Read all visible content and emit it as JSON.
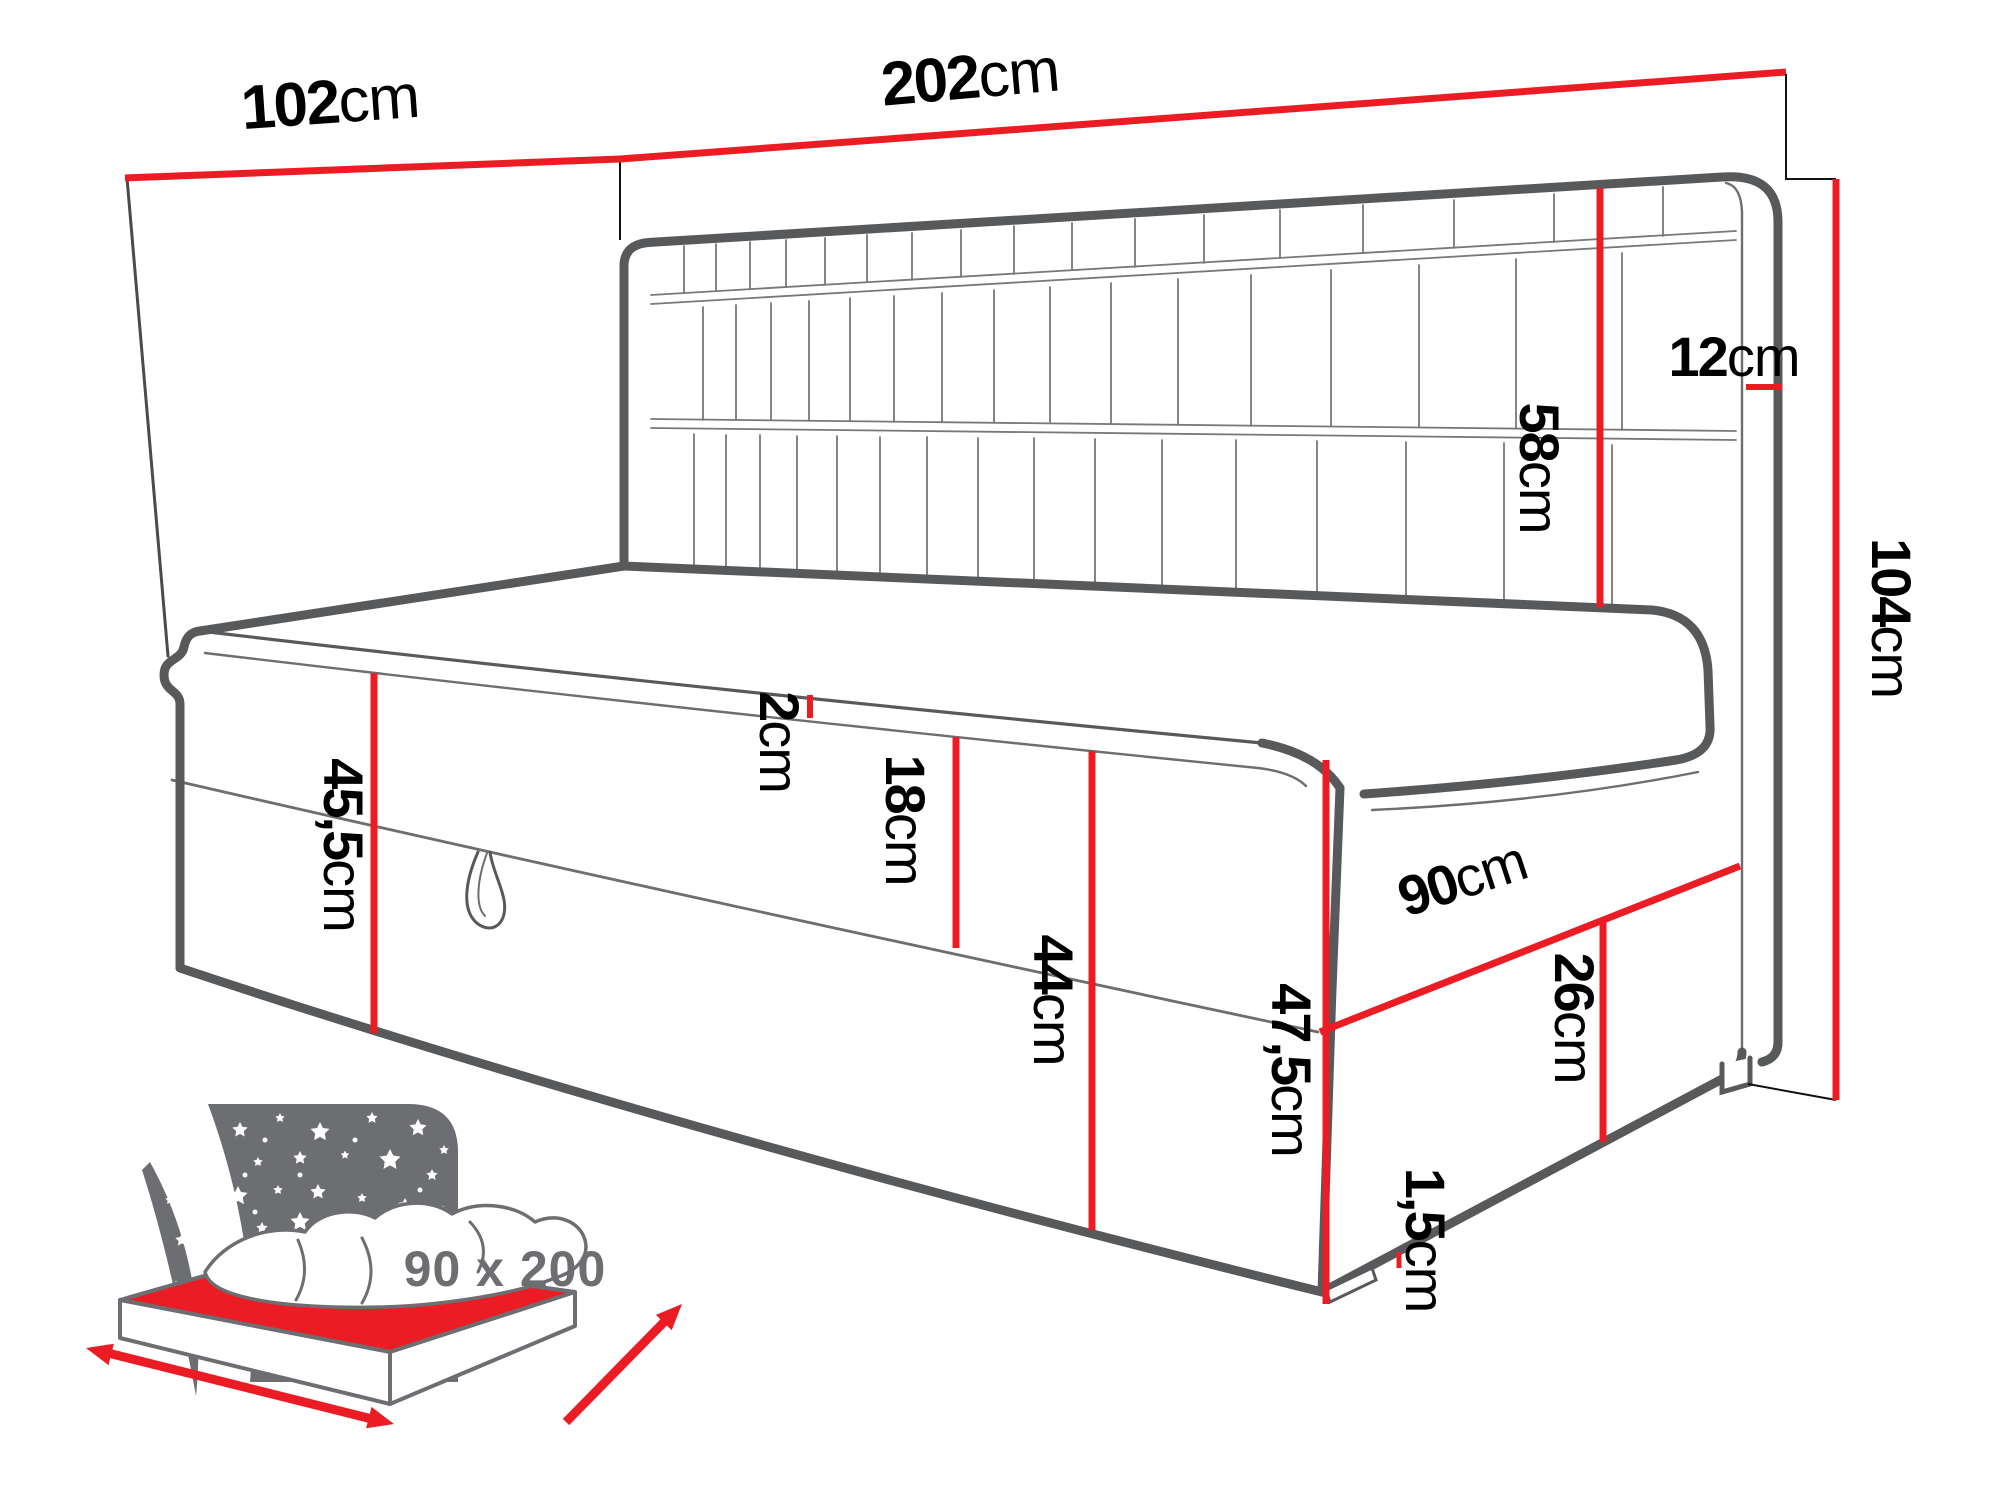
{
  "title": "upholstered daybed dimension diagram",
  "colors": {
    "dimension_red": "#ec1c24",
    "outline_gray": "#58595b",
    "icon_gray": "#6d6e71",
    "label_black": "#000000",
    "background": "#ffffff"
  },
  "dims": {
    "d102": {
      "value": "102",
      "unit": "cm"
    },
    "d202": {
      "value": "202",
      "unit": "cm"
    },
    "d12": {
      "value": "12",
      "unit": "cm"
    },
    "d58": {
      "value": "58",
      "unit": "cm"
    },
    "d104": {
      "value": "104",
      "unit": "cm"
    },
    "d455": {
      "value": "45,5",
      "unit": "cm"
    },
    "d2": {
      "value": "2",
      "unit": "cm"
    },
    "d18": {
      "value": "18",
      "unit": "cm"
    },
    "d44": {
      "value": "44",
      "unit": "cm"
    },
    "d475": {
      "value": "47,5",
      "unit": "cm"
    },
    "d90": {
      "value": "90",
      "unit": "cm"
    },
    "d26": {
      "value": "26",
      "unit": "cm"
    },
    "d15": {
      "value": "1,5",
      "unit": "cm"
    }
  },
  "icon": {
    "size_label": "90 x 200"
  }
}
